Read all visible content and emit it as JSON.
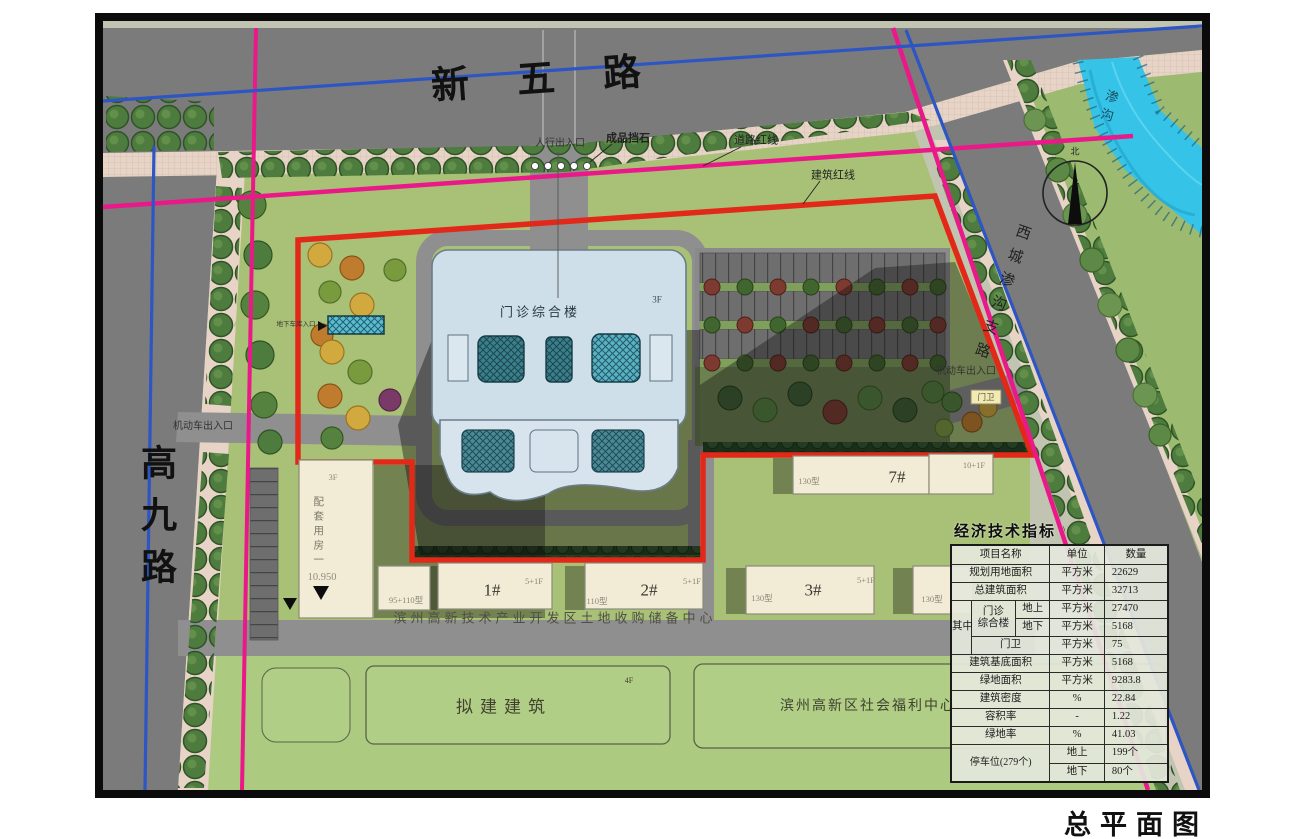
{
  "caption": "总平面图",
  "labels": {
    "road_north": "新五路",
    "road_west": "高九路",
    "road_east": "西城渗沟支路",
    "canal": "渗沟",
    "north_char": "北",
    "pedestrian_entrance": "人行出入口",
    "stone_barrier": "成品挡石",
    "road_red_line": "道路红线",
    "building_red_line": "建筑红线",
    "vehicle_entrance_west": "机动车出入口",
    "vehicle_entrance_east": "机动车出入口",
    "gate_guard": "门卫",
    "garage_entrance": "地下车库入口",
    "main_building": "门诊综合楼",
    "main_floors": "3F",
    "support_building": "配套用房一",
    "support_floors": "3F",
    "support_elevation": "10.950",
    "b1_num": "1#",
    "b1_type": "95+110型",
    "b1_spec": "5+1F",
    "b2_num": "2#",
    "b2_type": "110型",
    "b2_spec": "5+1F",
    "b3_num": "3#",
    "b3_type": "130型",
    "b3_spec": "5+1F",
    "b4_type": "130型",
    "b7_num": "7#",
    "b7_type": "130型",
    "b7_spec": "10+1F",
    "landbank": "滨州高新技术产业开发区土地收购储备中心",
    "proposed": "拟建建筑",
    "proposed_floors": "4F",
    "welfare": "滨州高新区社会福利中心"
  },
  "indicators": {
    "title": "经济技术指标",
    "col_name": "项目名称",
    "col_unit": "单位",
    "col_qty": "数量",
    "plan_area": {
      "name": "规划用地面积",
      "unit": "平方米",
      "qty": "22629"
    },
    "total_area": {
      "name": "总建筑面积",
      "unit": "平方米",
      "qty": "32713"
    },
    "among": "其中",
    "clinic": "门诊 综合楼",
    "above": "地上",
    "below": "地下",
    "clinic_above": {
      "unit": "平方米",
      "qty": "27470"
    },
    "clinic_below": {
      "unit": "平方米",
      "qty": "5168"
    },
    "guard": {
      "name": "门卫",
      "unit": "平方米",
      "qty": "75"
    },
    "footprint": {
      "name": "建筑基底面积",
      "unit": "平方米",
      "qty": "5168"
    },
    "green_area": {
      "name": "绿地面积",
      "unit": "平方米",
      "qty": "9283.8"
    },
    "density": {
      "name": "建筑密度",
      "unit": "%",
      "qty": "22.84"
    },
    "far": {
      "name": "容积率",
      "unit": "-",
      "qty": "1.22"
    },
    "green_rate": {
      "name": "绿地率",
      "unit": "%",
      "qty": "41.03"
    },
    "parking": {
      "name": "停车位(279个)",
      "up_label": "地上",
      "up_qty": "199个",
      "down_label": "地下",
      "down_qty": "80个"
    }
  },
  "colors": {
    "building_red_line": "#e22818",
    "planning_magenta": "#ea1889",
    "road_blue_line": "#2d55c4",
    "water": "#36c3e8",
    "main_building_fill": "#cfdfea",
    "residential_fill": "#f2ebd6",
    "road_gray": "#7b7b7b",
    "lawn_green": "#a9c176"
  }
}
